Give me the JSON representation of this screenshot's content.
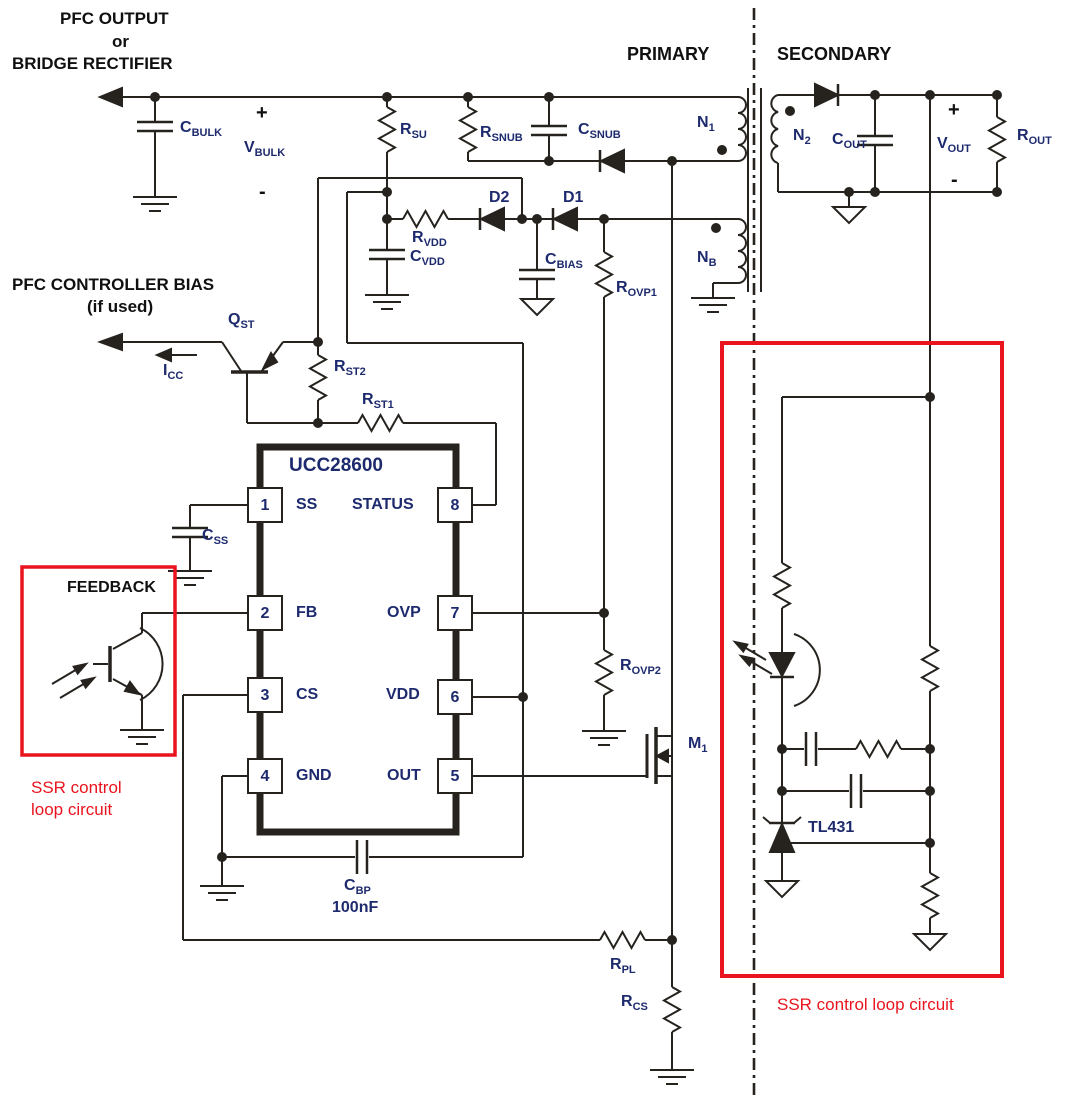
{
  "headers": {
    "source_line1": "PFC OUTPUT",
    "source_line2": "or",
    "source_line3": "BRIDGE RECTIFIER",
    "bias_line1": "PFC CONTROLLER BIAS",
    "bias_line2": "(if used)",
    "primary": "PRIMARY",
    "secondary": "SECONDARY",
    "feedback": "FEEDBACK"
  },
  "ic": {
    "title": "UCC28600",
    "pins": [
      {
        "num": "1",
        "name": "SS"
      },
      {
        "num": "2",
        "name": "FB"
      },
      {
        "num": "3",
        "name": "CS"
      },
      {
        "num": "4",
        "name": "GND"
      },
      {
        "num": "5",
        "name": "OUT"
      },
      {
        "num": "6",
        "name": "VDD"
      },
      {
        "num": "7",
        "name": "OVP"
      },
      {
        "num": "8",
        "name": "STATUS"
      }
    ]
  },
  "components": {
    "c_bulk": {
      "main": "C",
      "sub": "BULK"
    },
    "v_bulk": {
      "main": "V",
      "sub": "BULK"
    },
    "r_su": {
      "main": "R",
      "sub": "SU"
    },
    "r_snub": {
      "main": "R",
      "sub": "SNUB"
    },
    "c_snub": {
      "main": "C",
      "sub": "SNUB"
    },
    "n1": {
      "main": "N",
      "sub": "1"
    },
    "n2": {
      "main": "N",
      "sub": "2"
    },
    "nb": {
      "main": "N",
      "sub": "B"
    },
    "c_out": {
      "main": "C",
      "sub": "OUT"
    },
    "v_out": {
      "main": "V",
      "sub": "OUT"
    },
    "r_out": {
      "main": "R",
      "sub": "OUT"
    },
    "d1": {
      "main": "D1",
      "sub": ""
    },
    "d2": {
      "main": "D2",
      "sub": ""
    },
    "r_vdd": {
      "main": "R",
      "sub": "VDD"
    },
    "c_vdd": {
      "main": "C",
      "sub": "VDD"
    },
    "c_bias": {
      "main": "C",
      "sub": "BIAS"
    },
    "r_ovp1": {
      "main": "R",
      "sub": "OVP1"
    },
    "r_ovp2": {
      "main": "R",
      "sub": "OVP2"
    },
    "q_st": {
      "main": "Q",
      "sub": "ST"
    },
    "i_cc": {
      "main": "I",
      "sub": "CC"
    },
    "r_st2": {
      "main": "R",
      "sub": "ST2"
    },
    "r_st1": {
      "main": "R",
      "sub": "ST1"
    },
    "c_ss": {
      "main": "C",
      "sub": "SS"
    },
    "m1": {
      "main": "M",
      "sub": "1"
    },
    "c_bp": {
      "main": "C",
      "sub": "BP"
    },
    "c_bp_value": "100nF",
    "r_pl": {
      "main": "R",
      "sub": "PL"
    },
    "r_cs": {
      "main": "R",
      "sub": "CS"
    },
    "tl431": "TL431"
  },
  "annotations": {
    "ssr_left_line1": "SSR control",
    "ssr_left_line2": "loop circuit",
    "ssr_right": "SSR control loop circuit",
    "plus": "+",
    "minus": "-"
  },
  "colors": {
    "wire": "#26221e",
    "label_navy": "#1e2a6e",
    "annotation_red": "#e9141d"
  }
}
